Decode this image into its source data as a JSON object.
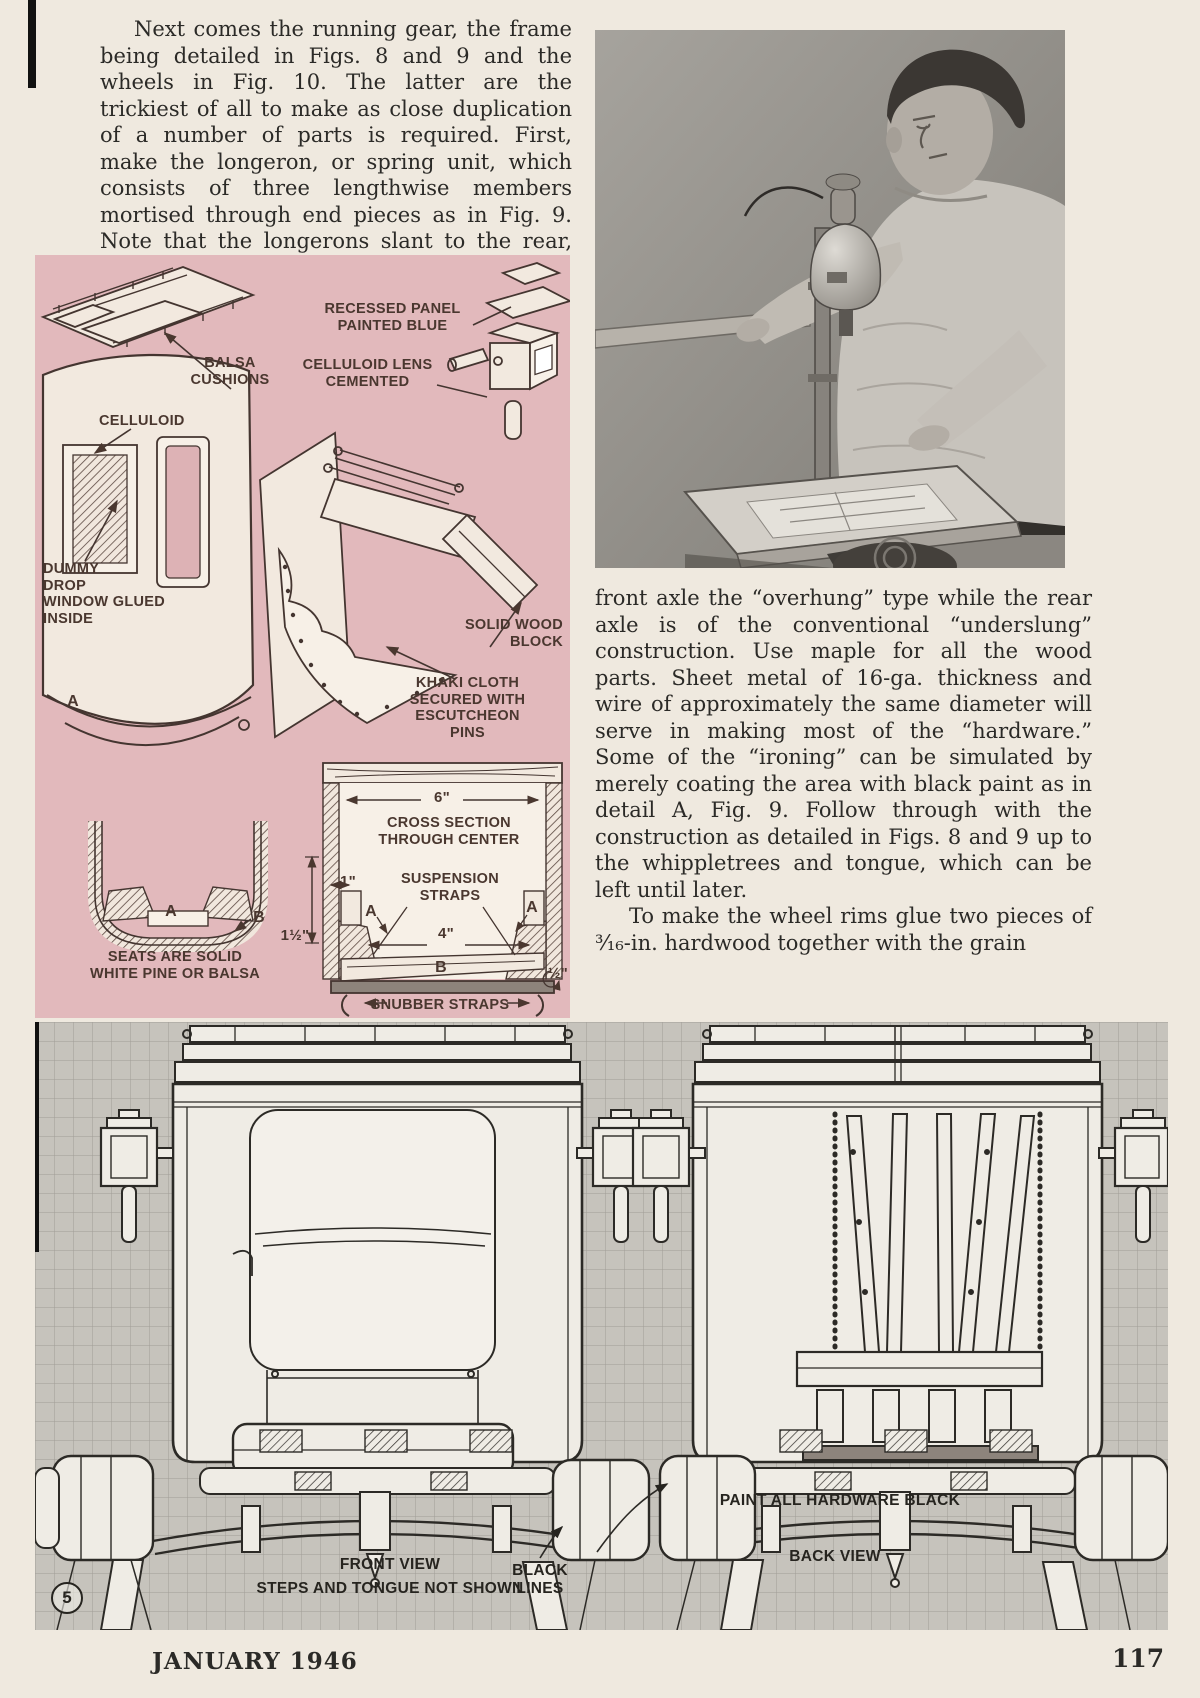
{
  "page": {
    "footer_left": "JANUARY 1946",
    "footer_right": "117"
  },
  "columns": {
    "left_paragraph": "Next comes the running gear, the frame being detailed in Figs. 8 and 9 and the wheels in Fig. 10. The latter are the trickiest of all to make as close duplication of a number of parts is required. First, make the longeron, or spring unit, which consists of three lengthwise members mortised through end pieces as in Fig. 9. Note that the longerons slant to the rear, making the",
    "right_paragraph_1": "front axle the “overhung” type while the rear axle is of the conventional “underslung” construction. Use maple for all the wood parts. Sheet metal of 16-ga. thickness and wire of approximately the same diameter will serve in making most of the “hardware.” Some of the “ironing” can be simulated by merely coating the area with black paint as in detail A, Fig. 9. Follow through with the construction as detailed in Figs. 8 and 9 up to the whippletrees and tongue, which can be left until later.",
    "right_paragraph_2": "To make the wheel rims glue two pieces of ³⁄₁₆-in. hardwood together with the grain"
  },
  "fig9": {
    "labels": {
      "recessed_panel": "RECESSED PANEL\nPAINTED BLUE",
      "balsa_cushions": "BALSA\nCUSHIONS",
      "celluloid_lens": "CELLULOID LENS\nCEMENTED",
      "celluloid": "CELLULOID",
      "dummy_window": "DUMMY\nDROP\nWINDOW GLUED\nINSIDE",
      "detail_a": "A",
      "solid_wood": "SOLID WOOD\nBLOCK",
      "khaki_cloth": "KHAKI CLOTH\nSECURED WITH\nESCUTCHEON\nPINS",
      "dim_6": "6\"",
      "cross_section": "CROSS SECTION\nTHROUGH CENTER",
      "dim_1": "1\"",
      "suspension": "SUSPENSION\nSTRAPS",
      "a_left": "A",
      "a_right": "A",
      "dim_1half": "1½\"",
      "dim_4": "4\"",
      "b_center": "B",
      "dim_half": "½\"",
      "snubber": "SNUBBER STRAPS",
      "seats": "SEATS ARE SOLID\nWHITE PINE OR BALSA",
      "seat_a": "A",
      "seat_b": "B"
    }
  },
  "fig5": {
    "labels": {
      "front_view": "FRONT VIEW",
      "steps": "STEPS AND TONGUE NOT SHOWN",
      "black_lines": "BLACK\nLINES",
      "paint": "PAINT ALL HARDWARE BLACK",
      "back_view": "BACK VIEW",
      "number": "5"
    }
  }
}
